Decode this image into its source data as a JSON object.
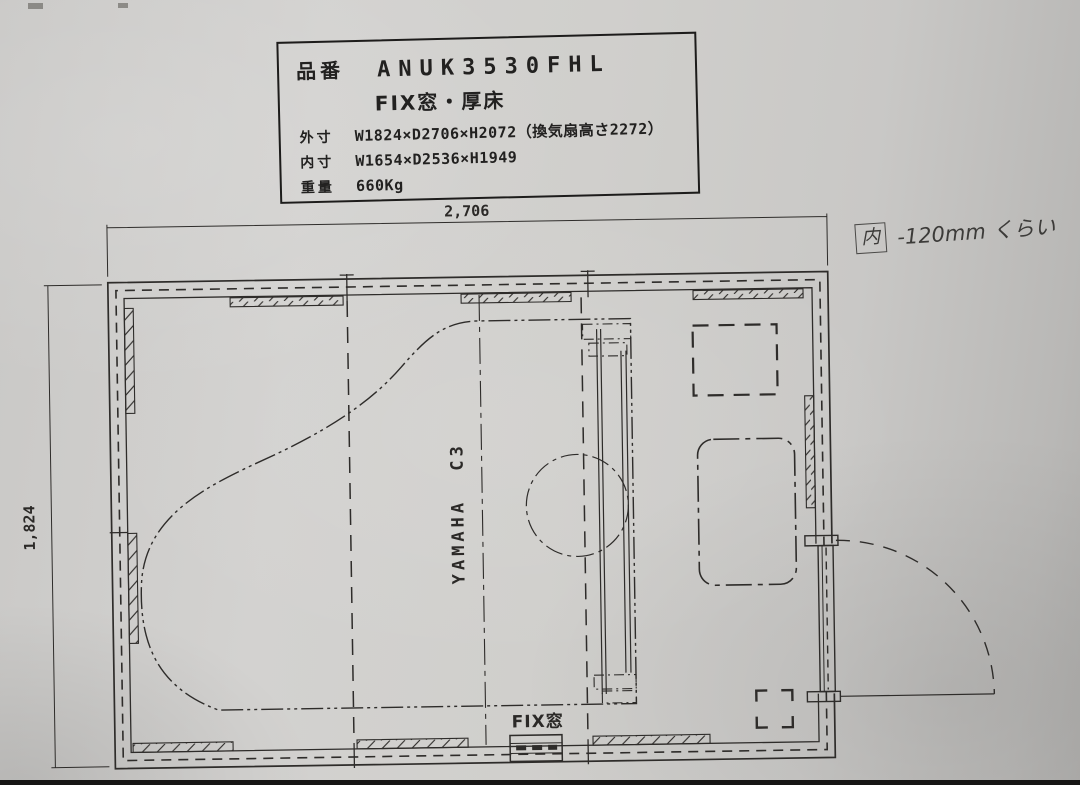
{
  "title_block": {
    "part_no_label": "品番",
    "part_no_value": "ANUK3530FHL",
    "subtitle": "FIX窓・厚床",
    "outer_dim_label": "外寸",
    "outer_dim_value": "W1824×D2706×H2072（換気扇高さ2272）",
    "inner_dim_label": "内寸",
    "inner_dim_value": "W1654×D2536×H1949",
    "weight_label": "重量",
    "weight_value": "660Kg"
  },
  "plan": {
    "top_dim": "2,706",
    "left_dim": "1,824",
    "piano_label": "YAMAHA C3",
    "window_label": "FIX窓"
  },
  "handwritten_note": {
    "prefix": "内",
    "text": "-120mm くらい"
  },
  "colors": {
    "paper": "#cfcecc",
    "ink": "#2e2c2a"
  }
}
